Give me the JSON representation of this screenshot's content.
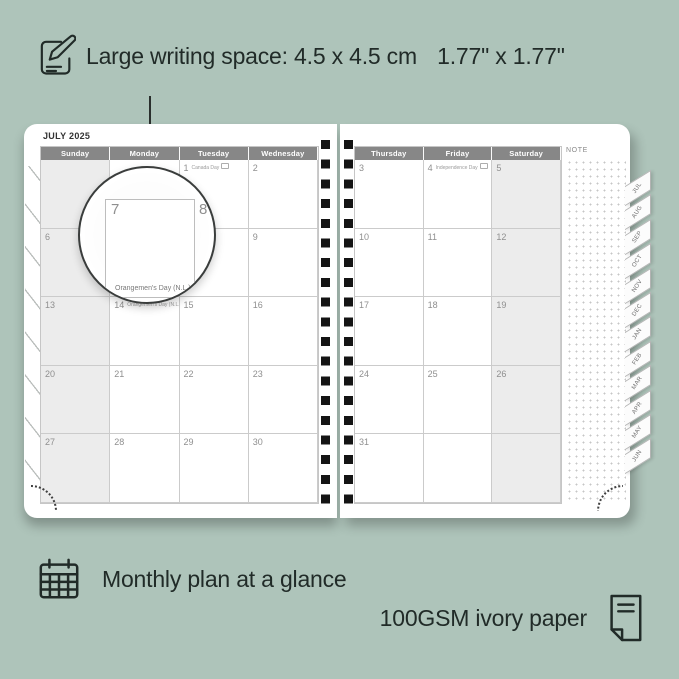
{
  "annotations": {
    "top": {
      "icon": "notepad-pencil-icon",
      "label": "Large writing space:",
      "metric": "4.5 x 4.5 cm",
      "imperial": "1.77\" x 1.77\""
    },
    "bottom_left": {
      "icon": "calendar-grid-icon",
      "label": "Monthly plan at a glance"
    },
    "bottom_right": {
      "icon": "paper-icon",
      "label": "100GSM ivory paper"
    }
  },
  "planner": {
    "title": "JULY 2025",
    "note_label": "NOTE",
    "left_page": {
      "shaded_col": 0,
      "headers": [
        "Sunday",
        "Monday",
        "Tuesday",
        "Wednesday"
      ],
      "rows": [
        [
          {
            "d": ""
          },
          {
            "d": ""
          },
          {
            "d": "1",
            "h": "Canada Day"
          },
          {
            "d": "2"
          }
        ],
        [
          {
            "d": "6"
          },
          {
            "d": "7"
          },
          {
            "d": "8"
          },
          {
            "d": "9"
          }
        ],
        [
          {
            "d": "13"
          },
          {
            "d": "14",
            "h": "Orangemen's Day (N.L.)"
          },
          {
            "d": "15"
          },
          {
            "d": "16"
          }
        ],
        [
          {
            "d": "20"
          },
          {
            "d": "21"
          },
          {
            "d": "22"
          },
          {
            "d": "23"
          }
        ],
        [
          {
            "d": "27"
          },
          {
            "d": "28"
          },
          {
            "d": "29"
          },
          {
            "d": "30"
          }
        ]
      ]
    },
    "right_page": {
      "shaded_col": 2,
      "headers": [
        "Thursday",
        "Friday",
        "Saturday"
      ],
      "rows": [
        [
          {
            "d": "3"
          },
          {
            "d": "4",
            "h": "Independence Day"
          },
          {
            "d": "5"
          }
        ],
        [
          {
            "d": "10"
          },
          {
            "d": "11"
          },
          {
            "d": "12"
          }
        ],
        [
          {
            "d": "17"
          },
          {
            "d": "18"
          },
          {
            "d": "19"
          }
        ],
        [
          {
            "d": "24"
          },
          {
            "d": "25"
          },
          {
            "d": "26"
          }
        ],
        [
          {
            "d": "31"
          },
          {
            "d": ""
          },
          {
            "d": ""
          }
        ]
      ]
    },
    "tabs": [
      "JUL",
      "AUG",
      "SEP",
      "OCT",
      "NOV",
      "DEC",
      "JAN",
      "FEB",
      "MAR",
      "APR",
      "MAY",
      "JUN"
    ]
  },
  "magnifier": {
    "day_left": "7",
    "day_right": "8",
    "caption": "Orangemen's Day (N.L.)"
  },
  "colors": {
    "background": "#aec4ba",
    "ink": "#212b28",
    "header_bg": "#878787",
    "shaded_cell": "#ececec",
    "grid_line": "#cbcbcb",
    "date_text": "#8f8f8f",
    "spiral_hole": "#141414"
  }
}
